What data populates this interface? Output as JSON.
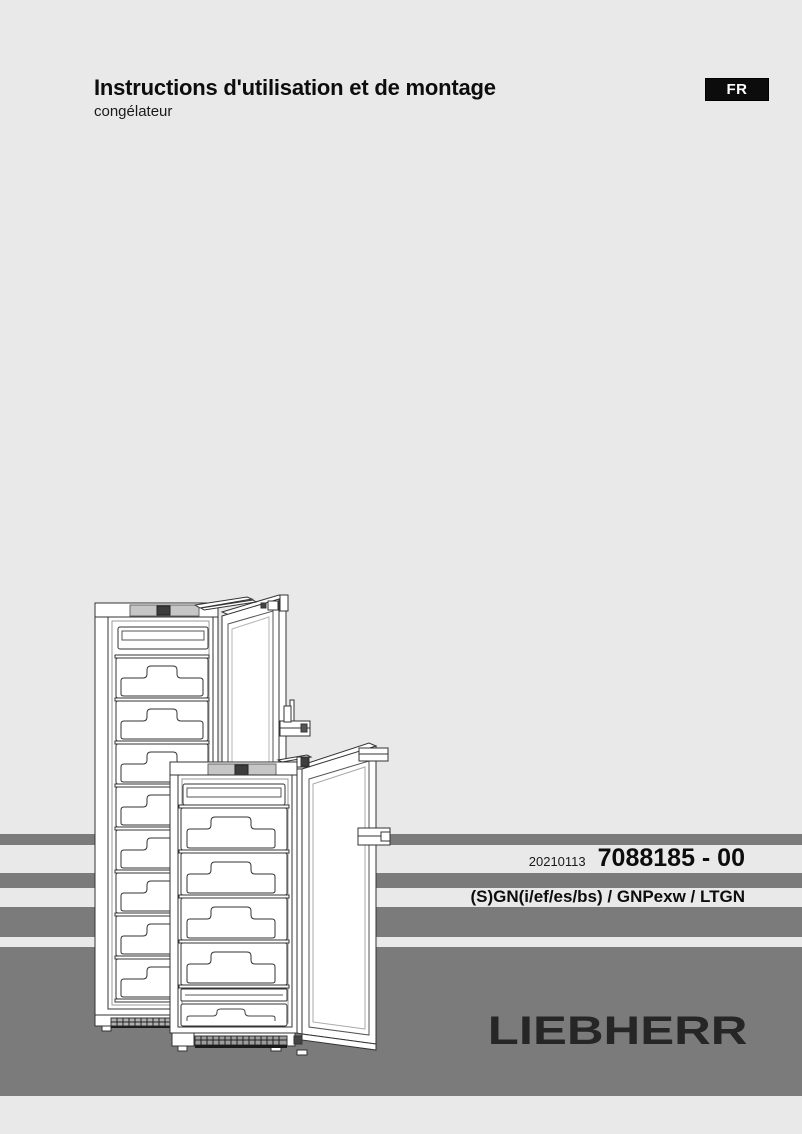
{
  "document": {
    "title": "Instructions d'utilisation et de montage",
    "subtitle": "congélateur",
    "language_badge": "FR"
  },
  "footer": {
    "date_code": "20210113",
    "doc_number": "7088185 - 00",
    "model_line": "(S)GN(i/ef/es/bs) / GNPexw / LTGN",
    "brand_logo": "LIEBHERR"
  },
  "illustration": {
    "name": "two-upright-freezers-with-open-doors-line-drawing"
  },
  "colors": {
    "page_bg": "#e9e9e9",
    "stripe_gray": "#7b7b7b",
    "badge_bg": "#0c0c0c",
    "badge_text": "#ffffff",
    "logo_color": "#262626",
    "text_color": "#111111",
    "control_panel_gray": "#c6c6c6",
    "display_square": "#3c3c3c"
  }
}
